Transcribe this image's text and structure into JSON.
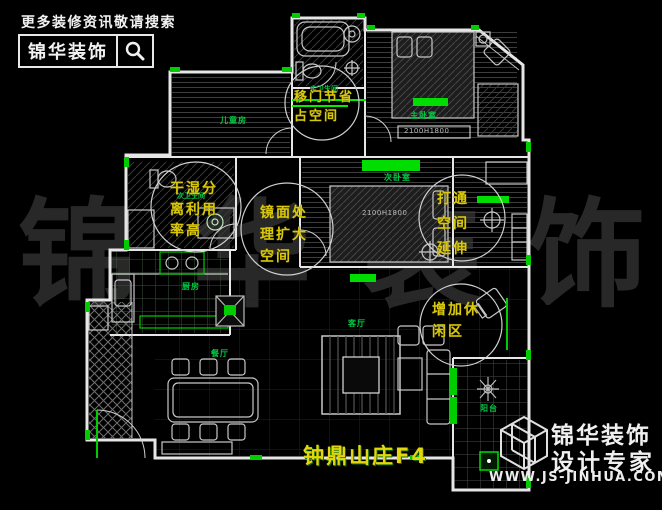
{
  "header": {
    "tagline": "更多装修资讯敬请搜索",
    "brand": "锦华装饰",
    "search_icon": "magnifier-icon"
  },
  "watermark": {
    "chars": [
      "锦",
      "华",
      "装",
      "饰"
    ]
  },
  "plan": {
    "title": "钟鼎山庄F4",
    "rooms": [
      {
        "label": "儿童房"
      },
      {
        "label": "主卫生间"
      },
      {
        "label": "主卧室"
      },
      {
        "label": "次卫生间"
      },
      {
        "label": "次卧室"
      },
      {
        "label": "厨房"
      },
      {
        "label": "餐厅"
      },
      {
        "label": "客厅"
      },
      {
        "label": "阳台"
      }
    ],
    "dimensions": [
      {
        "text": "2100H1800"
      },
      {
        "text": "2100H1800"
      }
    ],
    "annotations": [
      {
        "id": "sliding-door-saves-space",
        "lines": [
          "移门节省",
          "占空间"
        ]
      },
      {
        "id": "dry-wet-separation",
        "lines": [
          "干湿分",
          "离利用",
          "率高"
        ]
      },
      {
        "id": "mirror-enlarges-space",
        "lines": [
          "镜面处",
          "理扩大",
          "空间"
        ]
      },
      {
        "id": "open-up-space-extends",
        "lines": [
          "打通",
          "空间",
          "延伸"
        ]
      },
      {
        "id": "add-leisure-area",
        "lines": [
          "增加休",
          "闲区"
        ]
      }
    ]
  },
  "footer": {
    "brand_line1": "锦华装饰",
    "brand_line2": "设计专家",
    "website": "WWW.JS-JINHUA.COM",
    "logo_icon": "wireframe-cube-logo"
  },
  "colors": {
    "background": "#000000",
    "wall_line": "#e6e6e6",
    "accent_green": "#00dd00",
    "label_green": "#00cc44",
    "annotation_yellow": "#d9c80a",
    "watermark_gray": "#282828"
  }
}
